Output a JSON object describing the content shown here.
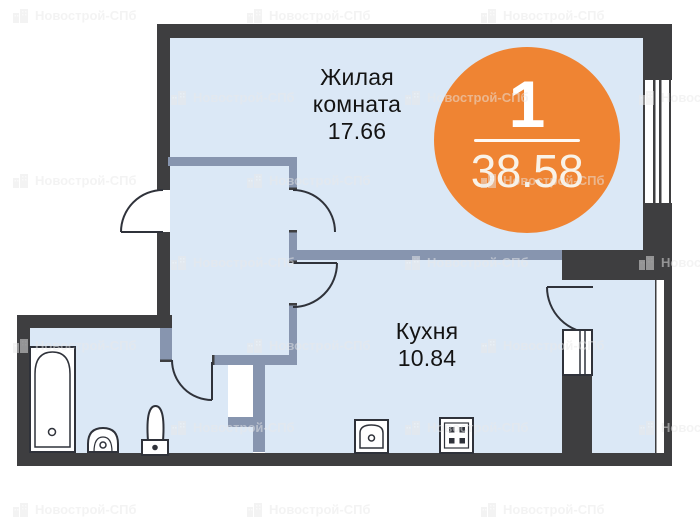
{
  "plan": {
    "rooms": [
      {
        "name": "Жилая комната",
        "area": "17.66"
      },
      {
        "name": "Кухня",
        "area": "10.84"
      }
    ],
    "badge": {
      "number": "1",
      "total_area": "38.58"
    },
    "fixtures": [
      "bathtub-icon",
      "pedestal-sink-icon",
      "toilet-icon",
      "kitchen-sink-icon",
      "stove-icon",
      "window-icon",
      "balcony-window-icon",
      "cabinet-icon"
    ]
  },
  "watermark": {
    "text": "Новострой-СПб"
  },
  "colors": {
    "wall": "#3E3E40",
    "partition": "#8795AF",
    "floor": "#DBE8F6",
    "accent_orange": "#EF8433"
  }
}
